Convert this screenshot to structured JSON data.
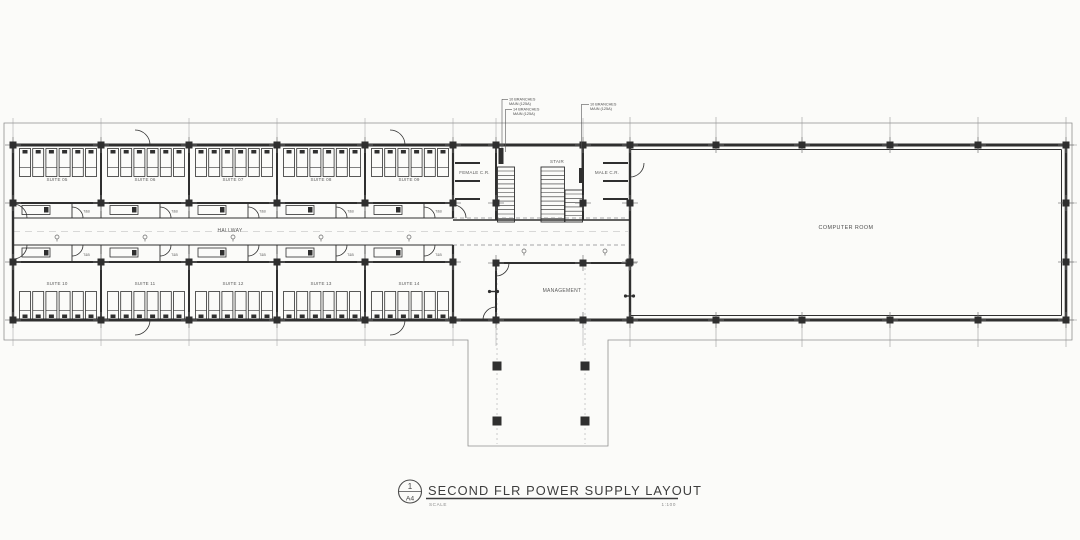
{
  "drawing": {
    "ink_color": "#2f2f2f",
    "thin_color": "#9a9a9a",
    "annotations": {
      "left_top": {
        "line1": "10 BRANCHES",
        "line2": "MAIN (125A)"
      },
      "left_bottom": {
        "line1": "14 BRANCHES",
        "line2": "MAIN (125A)"
      },
      "right": {
        "line1": "10 BRANCHES",
        "line2": "MAIN (125A)"
      }
    },
    "rooms": {
      "suites_top": [
        "SUITE 05",
        "SUITE 06",
        "SUITE 07",
        "SUITE 08",
        "SUITE 09"
      ],
      "suites_bottom": [
        "SUITE 10",
        "SUITE 11",
        "SUITE 12",
        "SUITE 13",
        "SUITE 14"
      ],
      "hallway": "HALLWAY",
      "female_cr": "FEMALE C.R.",
      "stair": "STAIR",
      "male_cr": "MALE C.R.",
      "management": "MANAGEMENT",
      "computer_room": "COMPUTER ROOM",
      "toilet_bath": "T&B"
    },
    "title_block": {
      "detail_number": "1",
      "sheet": "A4",
      "title": "SECOND FLR POWER SUPPLY LAYOUT",
      "scale_label": "SCALE",
      "scale_value": "1:100"
    }
  }
}
